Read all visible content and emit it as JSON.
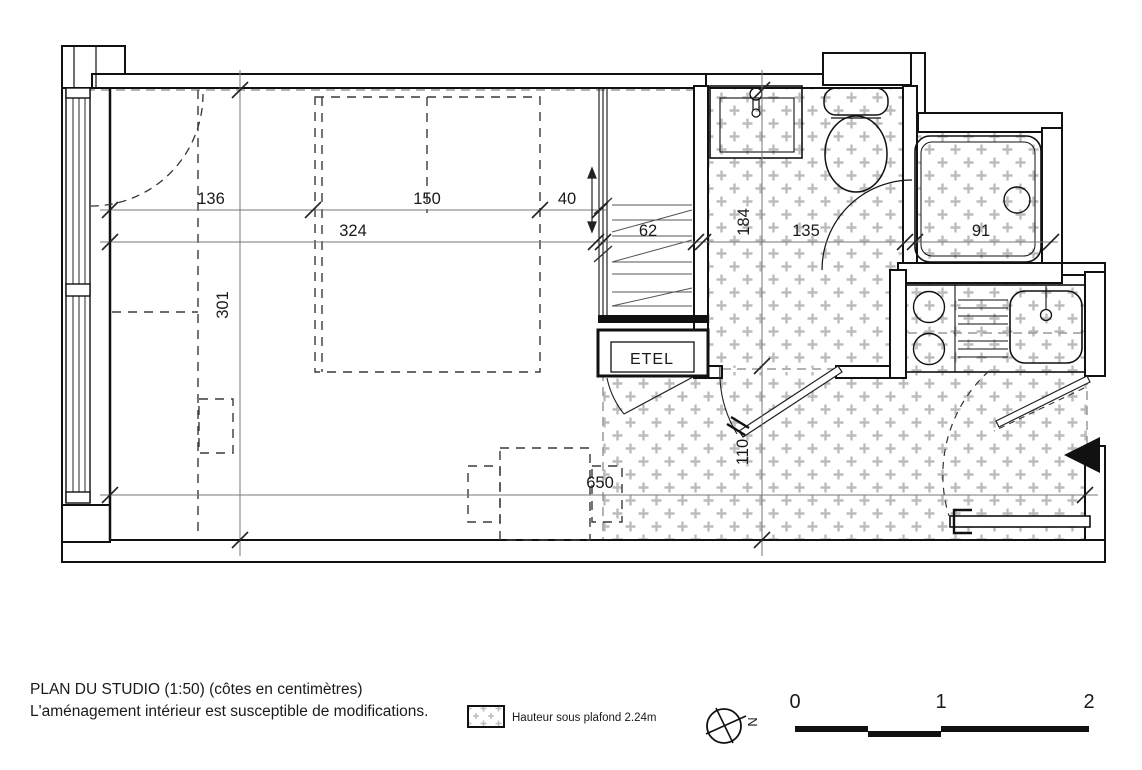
{
  "plan": {
    "labels": {
      "etel": "ETEL"
    },
    "dimensions": {
      "left_to_bed": "136",
      "bed_width": "150",
      "bed_gap": "40",
      "wall_span": "324",
      "closet_width": "62",
      "bathroom_depth": "184",
      "bathroom_width": "135",
      "shower_width": "91",
      "room_depth": "301",
      "hall_width": "110",
      "total_length": "650"
    }
  },
  "footer": {
    "title_line1": "PLAN DU STUDIO (1:50) (côtes en centimètres)",
    "title_line2": "L'aménagement intérieur est susceptible de modifications.",
    "legend_label": "Hauteur sous plafond 2.24m",
    "north_label": "N",
    "scale_labels": [
      "0",
      "1",
      "2"
    ]
  },
  "colors": {
    "wall": "#111111",
    "hatch": "#bcbcbc",
    "dash_furniture": "#3a3a3a",
    "dash_zone": "#9a9a9a",
    "dim_line": "#777777"
  }
}
